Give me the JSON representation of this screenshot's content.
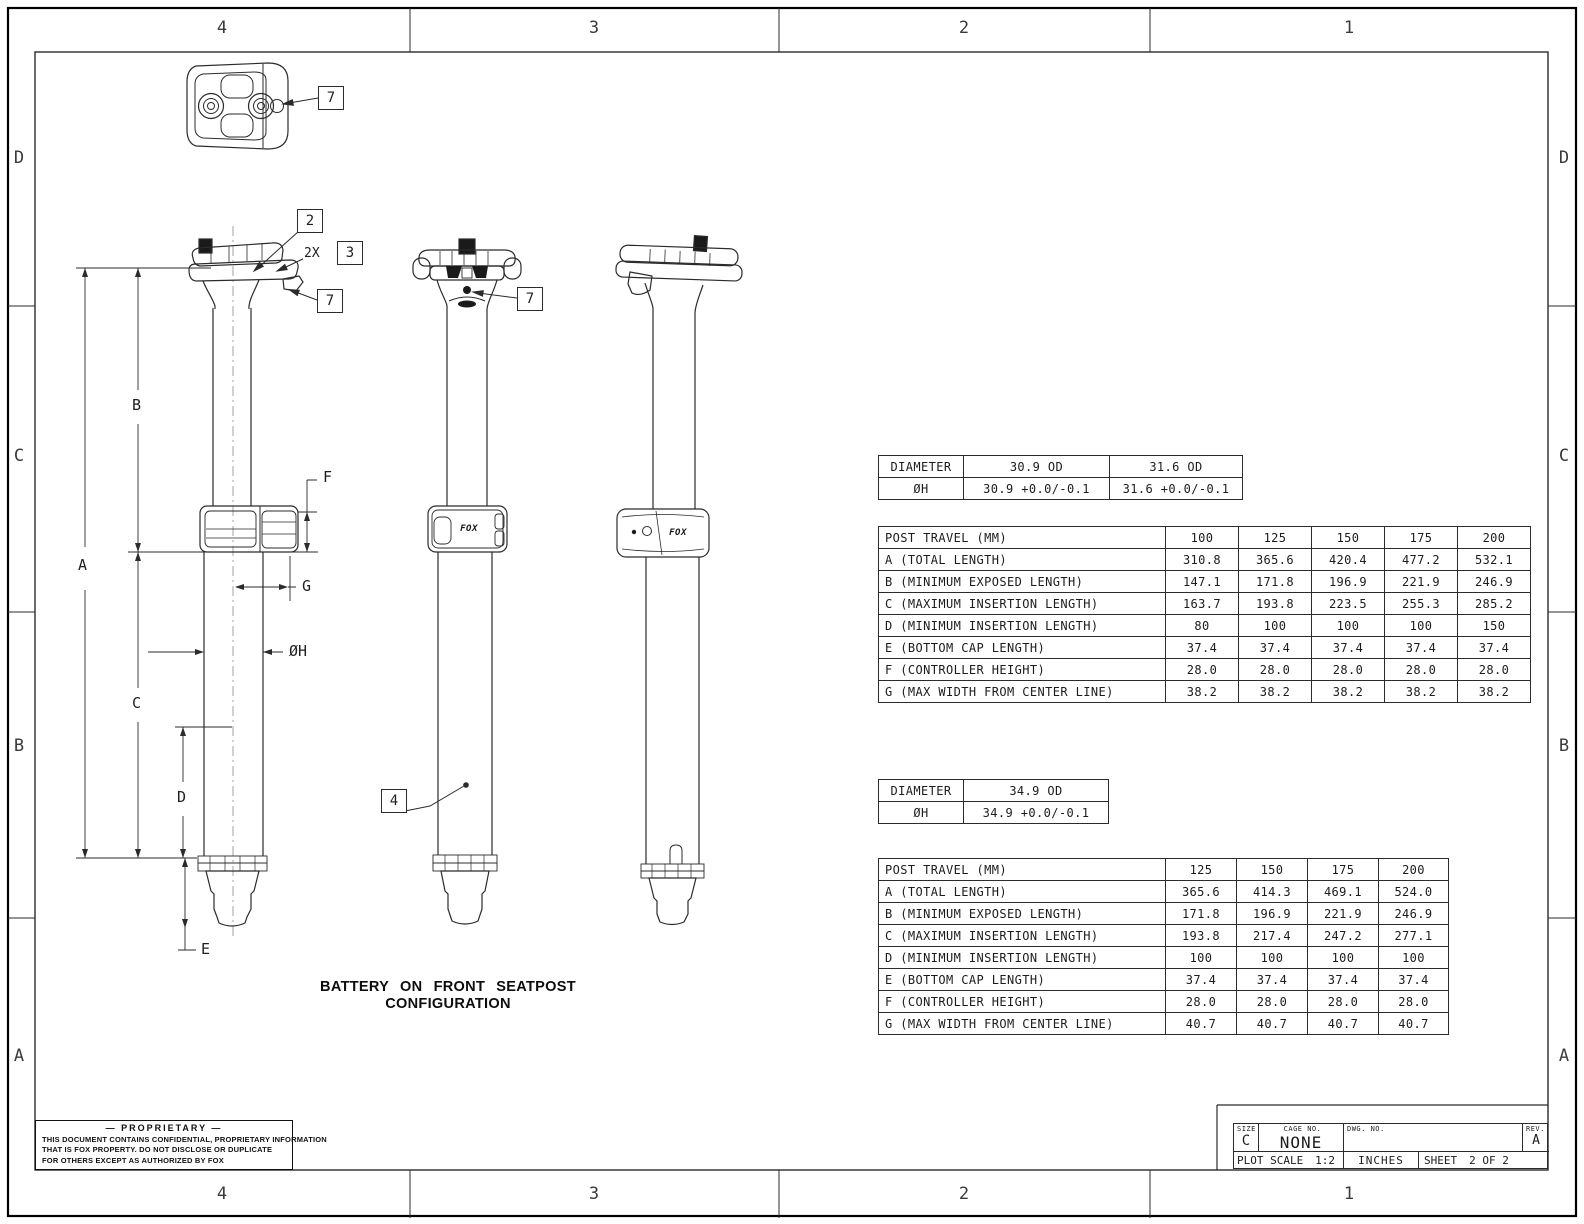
{
  "zones": {
    "cols": [
      "4",
      "3",
      "2",
      "1"
    ],
    "rows": [
      "D",
      "C",
      "B",
      "A"
    ]
  },
  "caption": "BATTERY ON FRONT SEATPOST CONFIGURATION",
  "logo": "FOX",
  "dims": {
    "a": "A",
    "b": "B",
    "c": "C",
    "d": "D",
    "e": "E",
    "f": "F",
    "g": "G",
    "h": "ØH",
    "qty2x": "2X"
  },
  "callouts": {
    "c2": "2",
    "c3": "3",
    "c4": "4",
    "c7": "7"
  },
  "tables": {
    "diam1": {
      "rows": [
        [
          "DIAMETER",
          "30.9 OD",
          "31.6 OD"
        ],
        [
          "ØH",
          "30.9 +0.0/-0.1",
          "31.6 +0.0/-0.1"
        ]
      ]
    },
    "travel1": {
      "rows": [
        [
          "POST TRAVEL (MM)",
          "100",
          "125",
          "150",
          "175",
          "200"
        ],
        [
          "A (TOTAL LENGTH)",
          "310.8",
          "365.6",
          "420.4",
          "477.2",
          "532.1"
        ],
        [
          "B (MINIMUM EXPOSED LENGTH)",
          "147.1",
          "171.8",
          "196.9",
          "221.9",
          "246.9"
        ],
        [
          "C (MAXIMUM INSERTION LENGTH)",
          "163.7",
          "193.8",
          "223.5",
          "255.3",
          "285.2"
        ],
        [
          "D (MINIMUM INSERTION LENGTH)",
          "80",
          "100",
          "100",
          "100",
          "150"
        ],
        [
          "E (BOTTOM CAP LENGTH)",
          "37.4",
          "37.4",
          "37.4",
          "37.4",
          "37.4"
        ],
        [
          "F (CONTROLLER HEIGHT)",
          "28.0",
          "28.0",
          "28.0",
          "28.0",
          "28.0"
        ],
        [
          "G (MAX WIDTH FROM CENTER LINE)",
          "38.2",
          "38.2",
          "38.2",
          "38.2",
          "38.2"
        ]
      ]
    },
    "diam2": {
      "rows": [
        [
          "DIAMETER",
          "34.9 OD"
        ],
        [
          "ØH",
          "34.9 +0.0/-0.1"
        ]
      ]
    },
    "travel2": {
      "rows": [
        [
          "POST TRAVEL (MM)",
          "125",
          "150",
          "175",
          "200"
        ],
        [
          "A (TOTAL LENGTH)",
          "365.6",
          "414.3",
          "469.1",
          "524.0"
        ],
        [
          "B (MINIMUM EXPOSED LENGTH)",
          "171.8",
          "196.9",
          "221.9",
          "246.9"
        ],
        [
          "C (MAXIMUM INSERTION LENGTH)",
          "193.8",
          "217.4",
          "247.2",
          "277.1"
        ],
        [
          "D (MINIMUM INSERTION LENGTH)",
          "100",
          "100",
          "100",
          "100"
        ],
        [
          "E (BOTTOM CAP LENGTH)",
          "37.4",
          "37.4",
          "37.4",
          "37.4"
        ],
        [
          "F (CONTROLLER HEIGHT)",
          "28.0",
          "28.0",
          "28.0",
          "28.0"
        ],
        [
          "G (MAX WIDTH FROM CENTER LINE)",
          "40.7",
          "40.7",
          "40.7",
          "40.7"
        ]
      ]
    }
  },
  "proprietary": {
    "title": "— PROPRIETARY —",
    "lines": [
      "THIS DOCUMENT CONTAINS CONFIDENTIAL, PROPRIETARY INFORMATION",
      "THAT IS FOX PROPERTY.  DO NOT DISCLOSE OR DUPLICATE",
      "FOR OTHERS EXCEPT AS AUTHORIZED BY FOX"
    ]
  },
  "title_block": {
    "size_label": "SIZE",
    "size_value": "C",
    "cage_label": "CAGE NO.",
    "cage_value": "NONE",
    "dwg_label": "DWG. NO.",
    "dwg_value": "",
    "rev_label": "REV.",
    "rev_value": "A",
    "plot_scale_label": "PLOT SCALE",
    "plot_scale_value": "1:2",
    "units_value": "INCHES",
    "sheet_label": "SHEET",
    "sheet_value": "2 OF 2"
  }
}
